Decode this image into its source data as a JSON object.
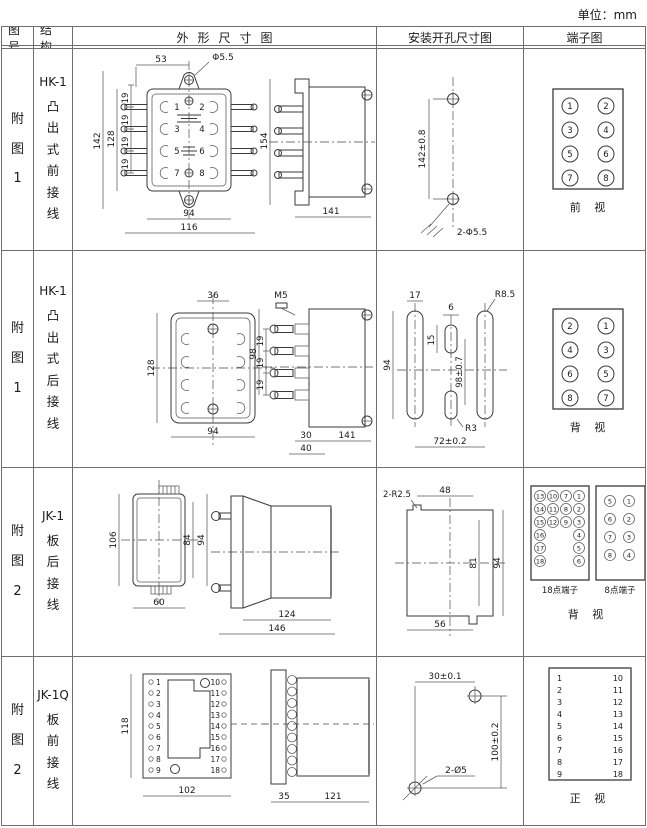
{
  "unit_label": "单位：mm",
  "headers": {
    "fig_no": "图号",
    "structure": "结构",
    "outline": "外形尺寸图",
    "mounting": "安装开孔尺寸图",
    "terminal": "端子图"
  },
  "rows": [
    {
      "fig_no": "附图1",
      "model": "HK-1",
      "structure": "凸出式前接线",
      "outline": {
        "w_top": "53",
        "hole": "Φ5.5",
        "h_outer": "142",
        "h_inner": "128",
        "pitch": [
          "19",
          "19",
          "19",
          "19"
        ],
        "pins": [
          "1",
          "2",
          "3",
          "4",
          "5",
          "6",
          "7",
          "8"
        ],
        "w_inner": "94",
        "w_outer": "116",
        "side_h": "154",
        "side_w": "141"
      },
      "mounting": {
        "hole_span": "142±0.8",
        "holes": "2-Φ5.5"
      },
      "terminal": {
        "pins": [
          "1",
          "2",
          "3",
          "4",
          "5",
          "6",
          "7",
          "8"
        ],
        "view": "前 视"
      }
    },
    {
      "fig_no": "附图1",
      "model": "HK-1",
      "structure": "凸出式后接线",
      "outline": {
        "w_top": "36",
        "h_outer": "128",
        "w_inner": "94",
        "stud": "M5",
        "side_h": "98",
        "pitch": [
          "19",
          "19",
          "19"
        ],
        "d30": "30",
        "d40": "40",
        "side_w": "141"
      },
      "mounting": {
        "slot_w": "17",
        "slot_h": "94",
        "center_w": "6",
        "center_h": "15",
        "span_v": "98±0.7",
        "r_outer": "R8.5",
        "r_center": "R3",
        "span_h": "72±0.2"
      },
      "terminal": {
        "pins": [
          "2",
          "1",
          "4",
          "3",
          "6",
          "5",
          "8",
          "7"
        ],
        "view": "背 视"
      }
    },
    {
      "fig_no": "附图2",
      "model": "JK-1",
      "structure": "板后接线",
      "outline": {
        "h_outer": "106",
        "h_mid": "84",
        "h_full": "94",
        "w": "60",
        "side_w1": "124",
        "side_w2": "146"
      },
      "mounting": {
        "radius": "2-R2.5",
        "w_top": "48",
        "h_inner": "81",
        "h_outer": "94",
        "w_bot": "56"
      },
      "terminal": {
        "t18_c1": [
          "13",
          "14",
          "15",
          "16",
          "17",
          "18"
        ],
        "t18_c2": [
          "10",
          "11",
          "12"
        ],
        "t18_c3": [
          "7",
          "8",
          "9"
        ],
        "t18_c4": [
          "1",
          "2",
          "3",
          "4",
          "5",
          "6"
        ],
        "t18_label": "18点端子",
        "t8_left": [
          "5",
          "6",
          "7",
          "8"
        ],
        "t8_right": [
          "1",
          "2",
          "3",
          "4"
        ],
        "t8_label": "8点端子",
        "view": "背 视"
      }
    },
    {
      "fig_no": "附图2",
      "model": "JK-1Q",
      "structure": "板前接线",
      "outline": {
        "h": "118",
        "w": "102",
        "left_pins": [
          "1",
          "2",
          "3",
          "4",
          "5",
          "6",
          "7",
          "8",
          "9"
        ],
        "right_pins": [
          "10",
          "11",
          "12",
          "13",
          "14",
          "15",
          "16",
          "17",
          "18"
        ],
        "side_w1": "35",
        "side_w2": "121"
      },
      "mounting": {
        "w": "30±0.1",
        "h": "100±0.2",
        "holes": "2-Ø5"
      },
      "terminal": {
        "left": [
          "1",
          "2",
          "3",
          "4",
          "5",
          "6",
          "7",
          "8",
          "9"
        ],
        "right": [
          "10",
          "11",
          "12",
          "13",
          "14",
          "15",
          "16",
          "17",
          "18"
        ],
        "view": "正 视"
      }
    }
  ]
}
